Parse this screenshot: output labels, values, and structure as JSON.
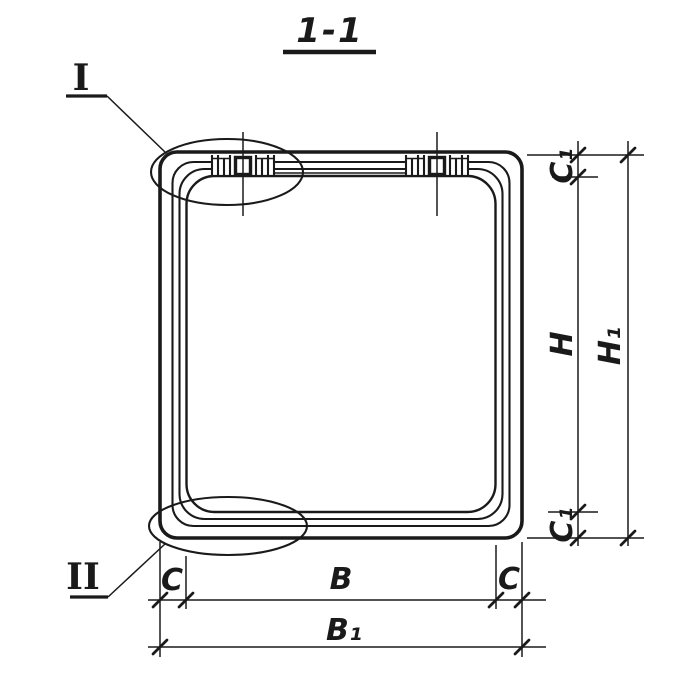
{
  "drawing": {
    "title": "1-1",
    "ink_color": "#1a1a1a",
    "background_color": "#ffffff",
    "type": "section-view-technical-drawing"
  },
  "detail_callouts": {
    "top_left": "I",
    "bottom_left": "II"
  },
  "dimensions": {
    "vertical": {
      "c1_top": "C₁",
      "inner_height": "H",
      "overall_height": "H₁",
      "c1_bottom": "C₁"
    },
    "horizontal": {
      "c_left": "C",
      "inner_width": "B",
      "c_right": "C",
      "overall_width": "B₁"
    }
  }
}
